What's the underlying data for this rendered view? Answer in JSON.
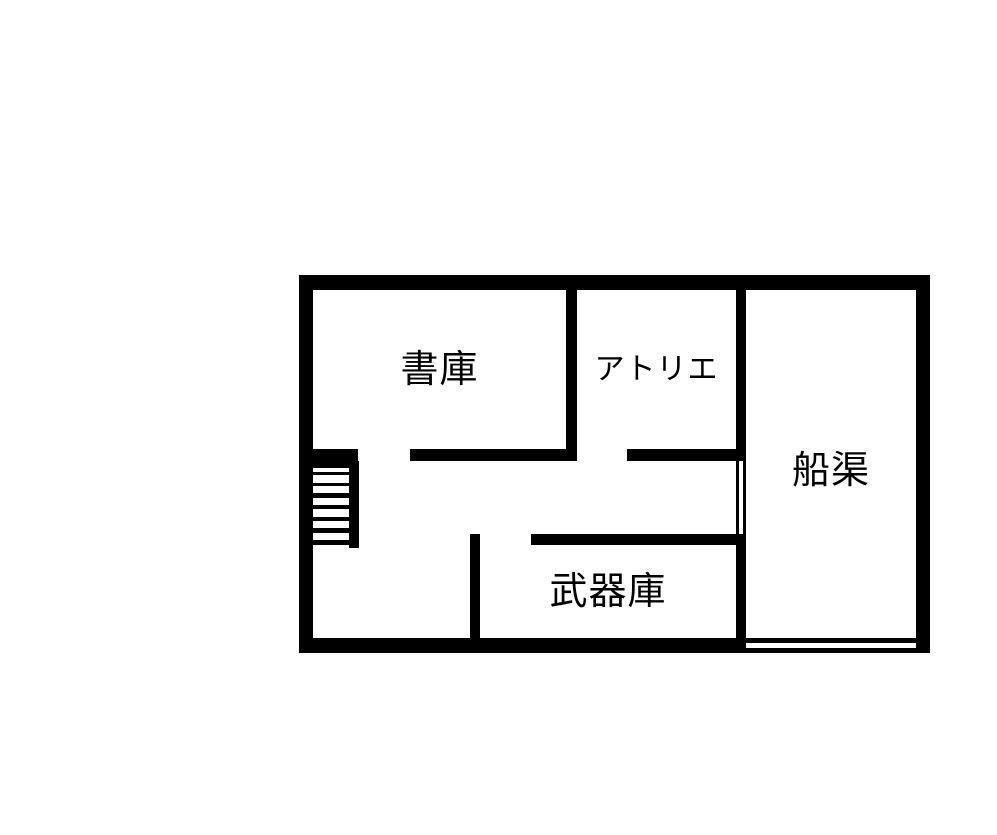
{
  "canvas": {
    "background": "#ffffff",
    "wall_color": "#000000",
    "floor_color": "#ffffff"
  },
  "floorplan": {
    "rooms": [
      {
        "id": "library",
        "label": "書庫"
      },
      {
        "id": "atelier",
        "label": "アトリエ"
      },
      {
        "id": "dock",
        "label": "船渠"
      },
      {
        "id": "armory",
        "label": "武器庫"
      }
    ],
    "stairs": {
      "steps": 7
    }
  }
}
